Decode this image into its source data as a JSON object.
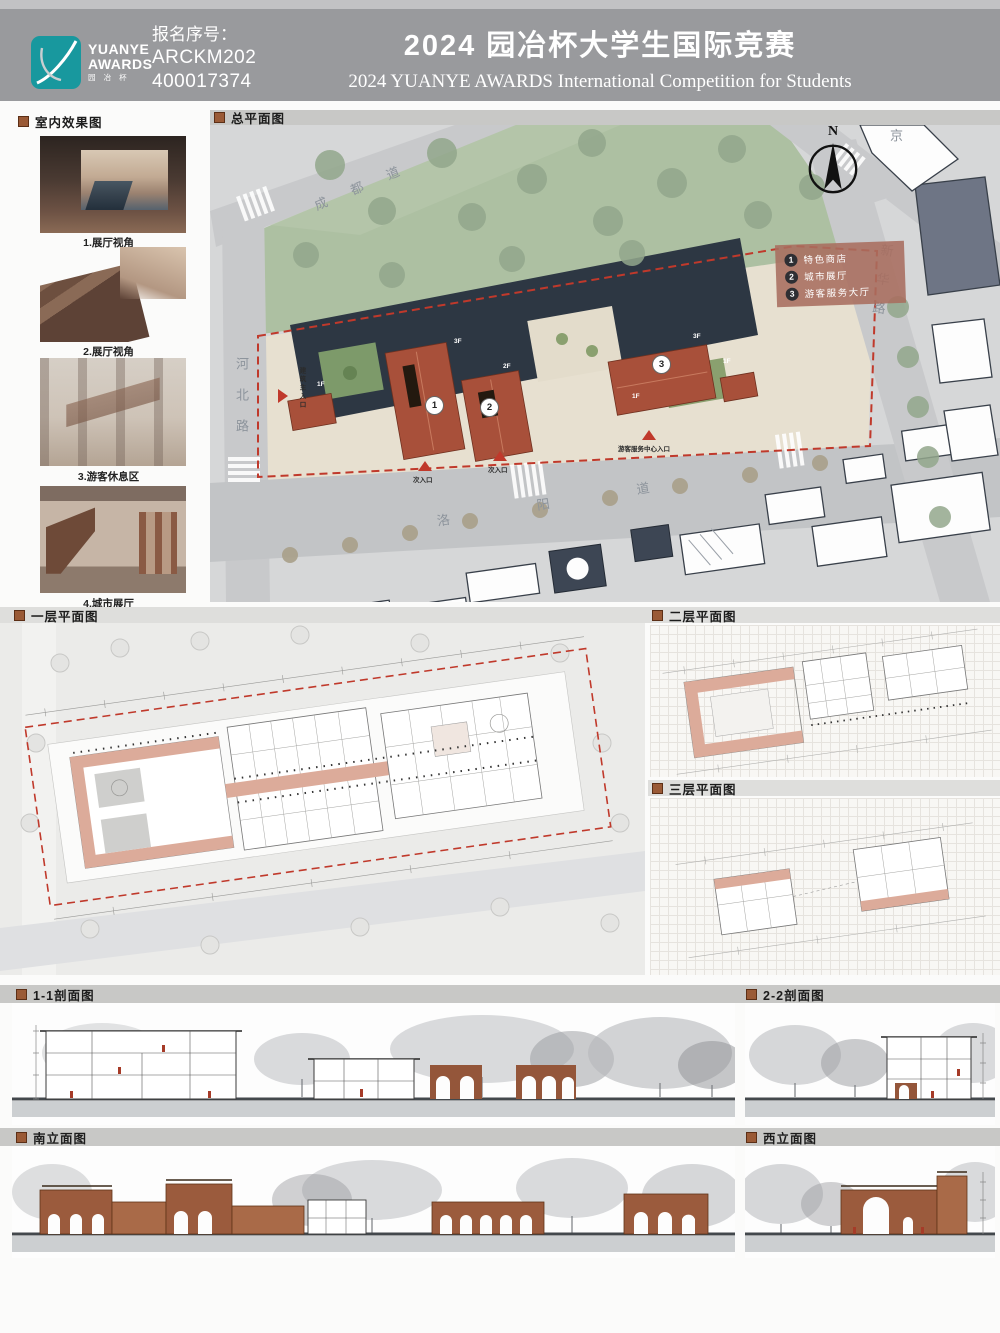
{
  "header": {
    "logo": {
      "line1": "YUANYE",
      "line2": "AWARDS",
      "cn": "园 冶 杯"
    },
    "reg": {
      "label": "报名序号：",
      "num1": "ARCKM202",
      "num2": "400017374"
    },
    "title_cn": "2024 园冶杯大学生国际竞赛",
    "title_en": "2024 YUANYE AWARDS International Competition for  Students"
  },
  "interior": {
    "title": "室内效果图",
    "items": [
      {
        "caption": "1.展厅视角"
      },
      {
        "caption": "2.展厅视角"
      },
      {
        "caption": "3.游客休息区"
      },
      {
        "caption": "4.城市展厅"
      }
    ]
  },
  "site_plan": {
    "title": "总平面图",
    "north": "N",
    "legend": [
      {
        "num": "1",
        "label": "特色商店"
      },
      {
        "num": "2",
        "label": "城市展厅"
      },
      {
        "num": "3",
        "label": "游客服务大厅"
      }
    ],
    "roads": {
      "top": "成都道",
      "left": "河北路",
      "bottom": "洛阳道",
      "right": "新华路",
      "corner": "京"
    },
    "entrances": {
      "main": "建筑主入口",
      "secondary1": "次入口",
      "secondary2": "次入口",
      "visitor": "游客服务中心入口"
    },
    "markers": [
      "1",
      "2",
      "3"
    ],
    "floor_tags": [
      "3F",
      "2F",
      "1F",
      "3F",
      "1F",
      "1F"
    ]
  },
  "plans": {
    "first": "一层平面图",
    "second": "二层平面图",
    "third": "三层平面图"
  },
  "sections": {
    "s11": "1-1剖面图",
    "s22": "2-2剖面图"
  },
  "elevations": {
    "south": "南立面图",
    "west": "西立面图"
  },
  "colors": {
    "teal": "#18989e",
    "header_gray": "#999a9d",
    "bullet_brown": "#9a5a36",
    "roof_red": "#a8503a",
    "boundary_red": "#c0392b",
    "wall_salmon": "#dcab9a",
    "park_green": "#adc0a2",
    "arch_brown": "#94563a"
  }
}
